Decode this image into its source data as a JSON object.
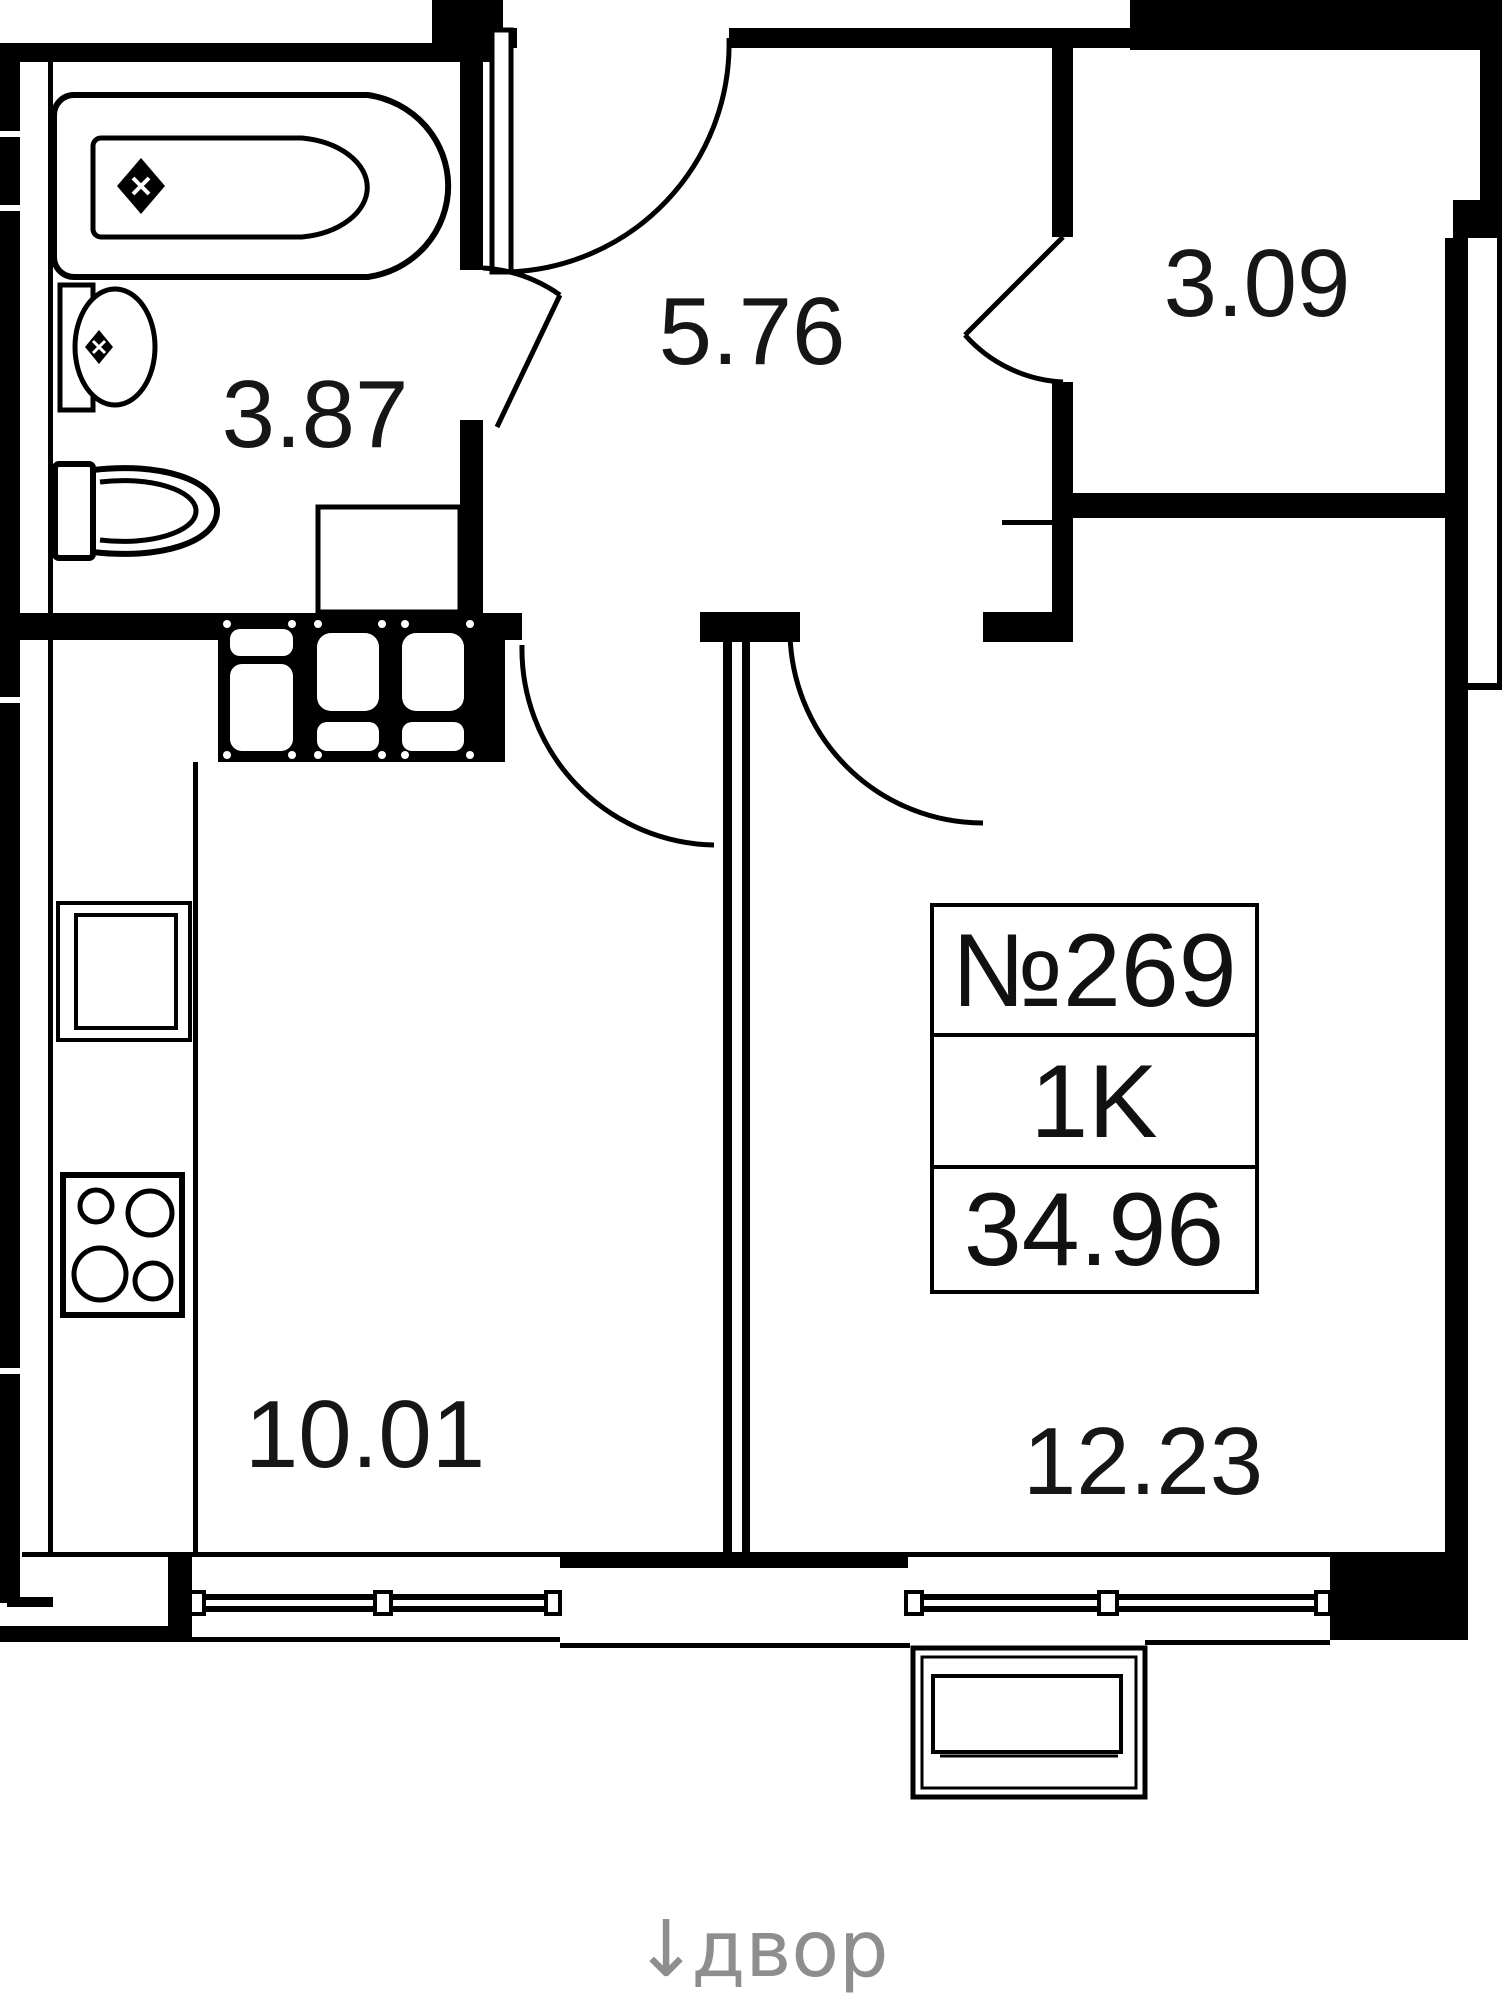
{
  "plan": {
    "unit": {
      "number": "№269",
      "rooms_label": "1K",
      "total_area": "34.96"
    },
    "rooms": [
      {
        "id": "bathroom",
        "area": "3.87"
      },
      {
        "id": "hallway",
        "area": "5.76"
      },
      {
        "id": "closet",
        "area": "3.09"
      },
      {
        "id": "kitchen",
        "area": "10.01"
      },
      {
        "id": "living-room",
        "area": "12.23"
      }
    ],
    "courtyard": {
      "arrow": "↓",
      "label": "двор"
    },
    "colors": {
      "line": "#000000",
      "muted": "#8e8e8e",
      "background": "#ffffff"
    }
  }
}
